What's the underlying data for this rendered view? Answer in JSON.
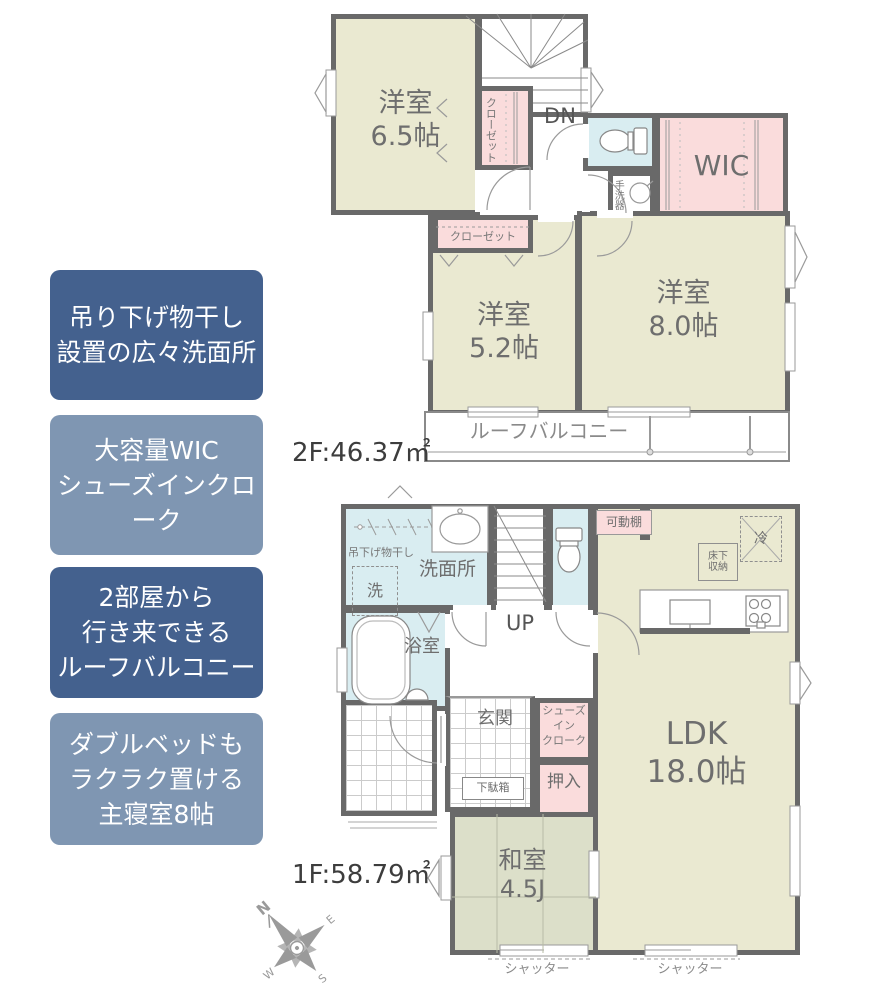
{
  "palette": {
    "wall": "#696969",
    "room_cream": "#eae9d1",
    "wet_blue": "#d9edf1",
    "storage_pink": "#fadcdc",
    "tatami_green": "#dcdfc9",
    "callout_dark": "#44618e",
    "callout_light": "#7f96b2"
  },
  "callouts": {
    "items": [
      {
        "text": "吊り下げ物干し\n設置の広々洗面所"
      },
      {
        "text": "大容量WIC\nシューズインクローク"
      },
      {
        "text": "2部屋から\n行き来できる\nルーフバルコニー"
      },
      {
        "text": "ダブルベッドも\nラクラク置ける\n主寝室8帖"
      }
    ]
  },
  "f2": {
    "area": "2F:46.37㎡",
    "rooms": {
      "y65": "洋室\n6.5帖",
      "y52": "洋室\n5.2帖",
      "y80": "洋室\n8.0帖",
      "wic": "WIC",
      "closet_v": "クローゼット",
      "closet_h": "クローゼット",
      "tearaiki": "手洗器",
      "dn": "DN",
      "balcony": "ルーフバルコニー"
    }
  },
  "f1": {
    "area": "1F:58.79㎡",
    "rooms": {
      "senmenjo": "洗面所",
      "monohoshi": "吊下げ物干し",
      "sen": "洗",
      "up": "UP",
      "kadoudana": "可動棚",
      "rei": "冷",
      "yukashita": "床下\n収納",
      "ldk": "LDK\n18.0帖",
      "bath": "浴室",
      "genkan": "玄関",
      "sic": "シューズ\nイン\nクローク",
      "oshiire": "押入",
      "getabako": "下駄箱",
      "washitsu": "和室\n4.5J",
      "shutter": "シャッター"
    }
  },
  "compass": {
    "n": "N",
    "e": "E",
    "s": "S",
    "w": "W"
  }
}
